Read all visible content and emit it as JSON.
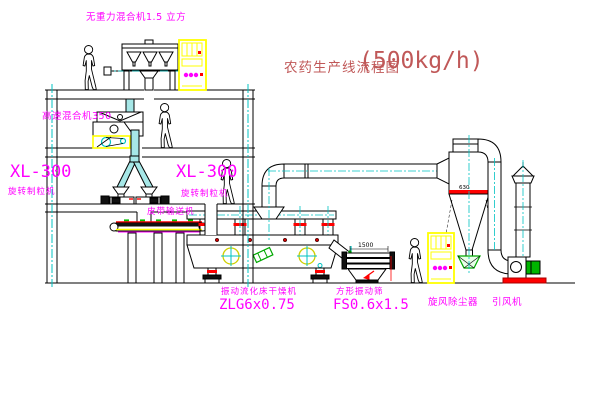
{
  "title": {
    "name": "农药生产线流程图",
    "capacity": "(500kg/h)"
  },
  "labels": {
    "gravity_mixer": "无重力混合机1.5 立方",
    "high_speed_mixer": "高速混合机350",
    "granulator_left": {
      "model": "XL-300",
      "name": "旋转制粒机"
    },
    "granulator_right": {
      "model": "XL-300",
      "name": "旋转制粒机"
    },
    "belt_conveyor": "皮带输送机",
    "dryer": {
      "name": "振动流化床干燥机",
      "model": "ZLG6x0.75"
    },
    "screen": {
      "name": "方形振动筛",
      "model": "FS0.6x1.5"
    },
    "cyclone": "旋风除尘器",
    "fan": "引风机"
  },
  "dimensions": {
    "screen_width": "1500",
    "cyclone_diameter": "630"
  },
  "colors": {
    "label_magenta": "#FF00FF",
    "title_red": "#C05858",
    "line_black": "#000000",
    "centerline_cyan": "#00C3C3",
    "pipe_fill_cyan": "#A6E7E7",
    "highlight_yellow": "#FFFF00",
    "flange_red": "#FF0000",
    "valve_green": "#00A800",
    "background": "#FFFFFF"
  }
}
